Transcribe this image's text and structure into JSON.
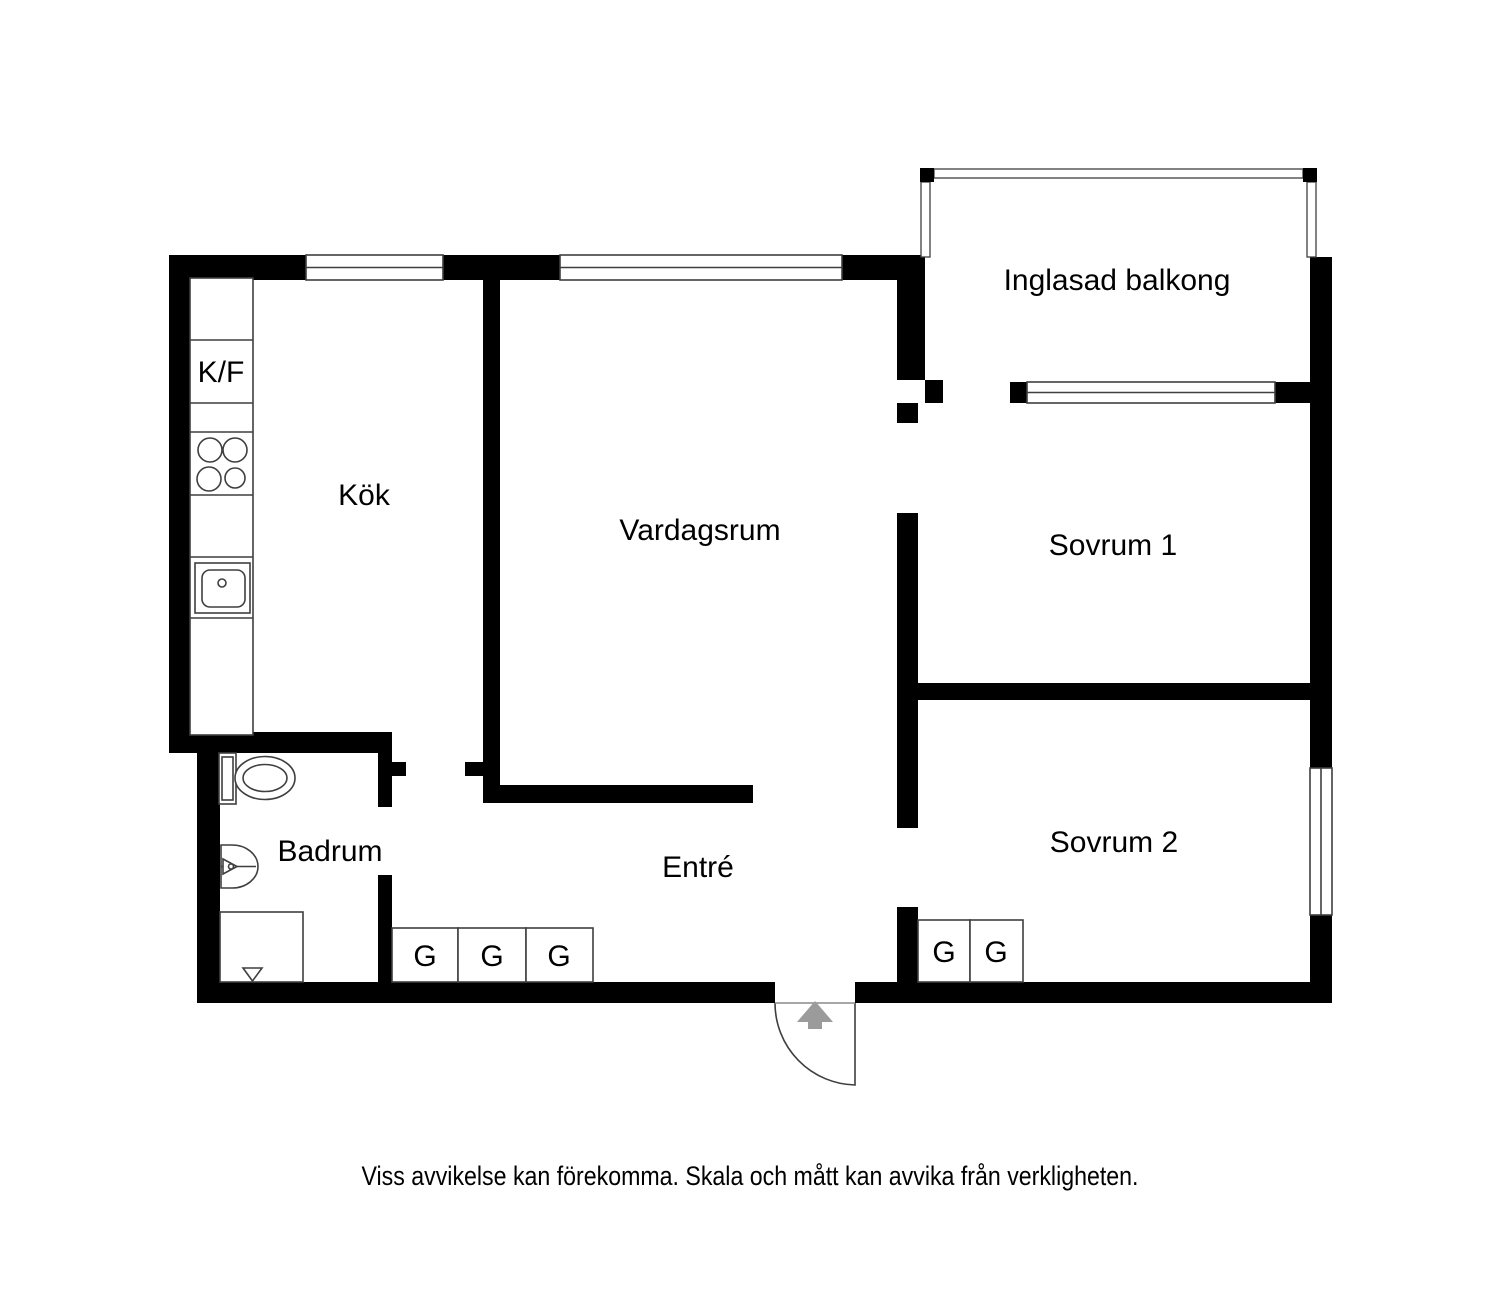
{
  "palette": {
    "wall": "#000000",
    "line": "#3f3f3f",
    "softline": "#8a8a8a",
    "arrow": "#9b9b9b",
    "text": "#000000",
    "bg": "#ffffff"
  },
  "rooms": {
    "kitchen": "Kök",
    "living_room": "Vardagsrum",
    "balcony": "Inglasad balkong",
    "bedroom1": "Sovrum 1",
    "bedroom2": "Sovrum 2",
    "bathroom": "Badrum",
    "entry": "Entré"
  },
  "fixtures": {
    "fridge_freezer_label": "K/F",
    "wardrobe_label": "G"
  },
  "wardrobes": {
    "entry_count": 3,
    "bedroom2_count": 2
  },
  "footer": {
    "disclaimer": "Viss avvikelse kan förekomma. Skala och mått kan avvika från verkligheten."
  }
}
